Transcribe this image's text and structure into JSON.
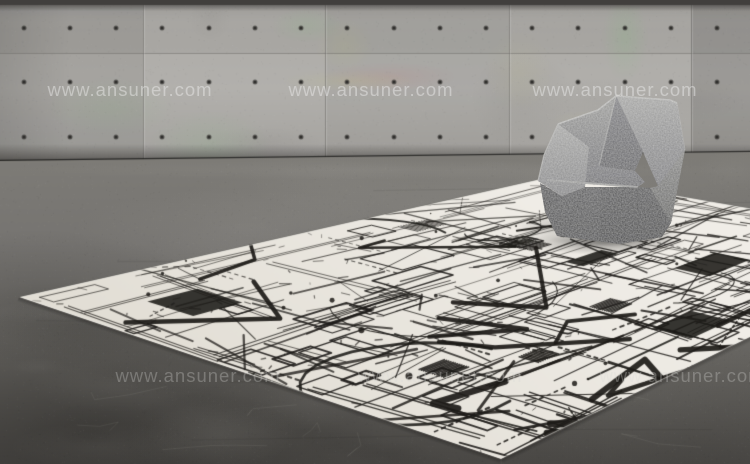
{
  "watermark": {
    "text": "www.ansuner.com"
  },
  "palette": {
    "wall_panel": "#a9a7a3",
    "wall_seam": "#6f6d69",
    "wall_tie_hole": "#2e2d2b",
    "wall_top_band": "#413f3d",
    "wall_base_shadow": "#272523",
    "floor_near_wall": "#7e7c77",
    "floor_mid": "#6b6965",
    "floor_dark": "#4d4b48",
    "floor_darkest": "#343230",
    "rug_ivory": "#f0ede7",
    "rug_ivory_deep": "#e2ded5",
    "rug_line": "#1d1b18",
    "chair_fabric_light": "#b4b4b2",
    "chair_fabric_mid": "#8f8f91",
    "chair_fabric_dark": "#636367",
    "chair_base": "#323234",
    "chair_rim": "#c9c9c7"
  }
}
